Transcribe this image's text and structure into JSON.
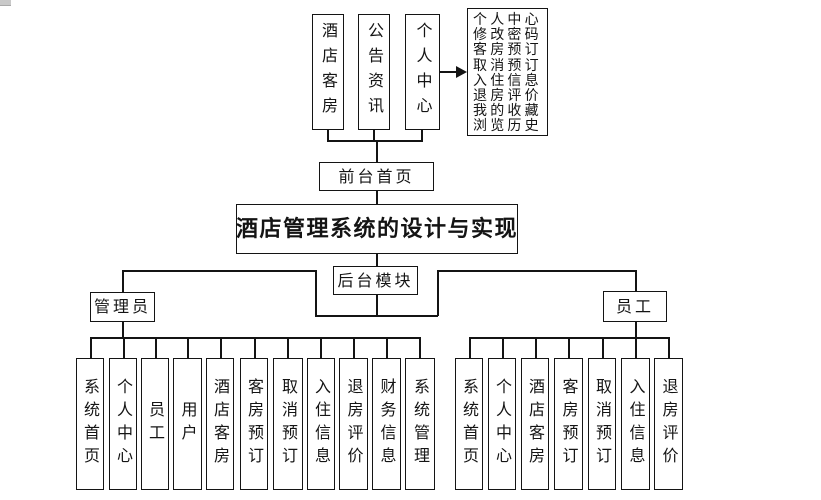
{
  "diagram": {
    "title": "酒店管理系统的设计与实现",
    "front_home": "前台首页",
    "backend_module": "后台模块",
    "top_modules": [
      "酒店客房",
      "公告资讯",
      "个人中心"
    ],
    "profile_menu": {
      "items": [
        "个人中心",
        "修改密码",
        "客房预订",
        "取消预订",
        "入住信息",
        "退房评价",
        "我的收藏",
        "浏览历史"
      ]
    },
    "admin": {
      "label": "管理员",
      "children": [
        "系统首页",
        "个人中心",
        "员工",
        "用户",
        "酒店客房",
        "客房预订",
        "取消预订",
        "入住信息",
        "退房评价",
        "财务信息",
        "系统管理"
      ]
    },
    "staff": {
      "label": "员工",
      "children": [
        "系统首页",
        "个人中心",
        "酒店客房",
        "客房预订",
        "取消预订",
        "入住信息",
        "退房评价"
      ]
    },
    "colors": {
      "line": "#141414",
      "background": "#ffffff"
    }
  }
}
